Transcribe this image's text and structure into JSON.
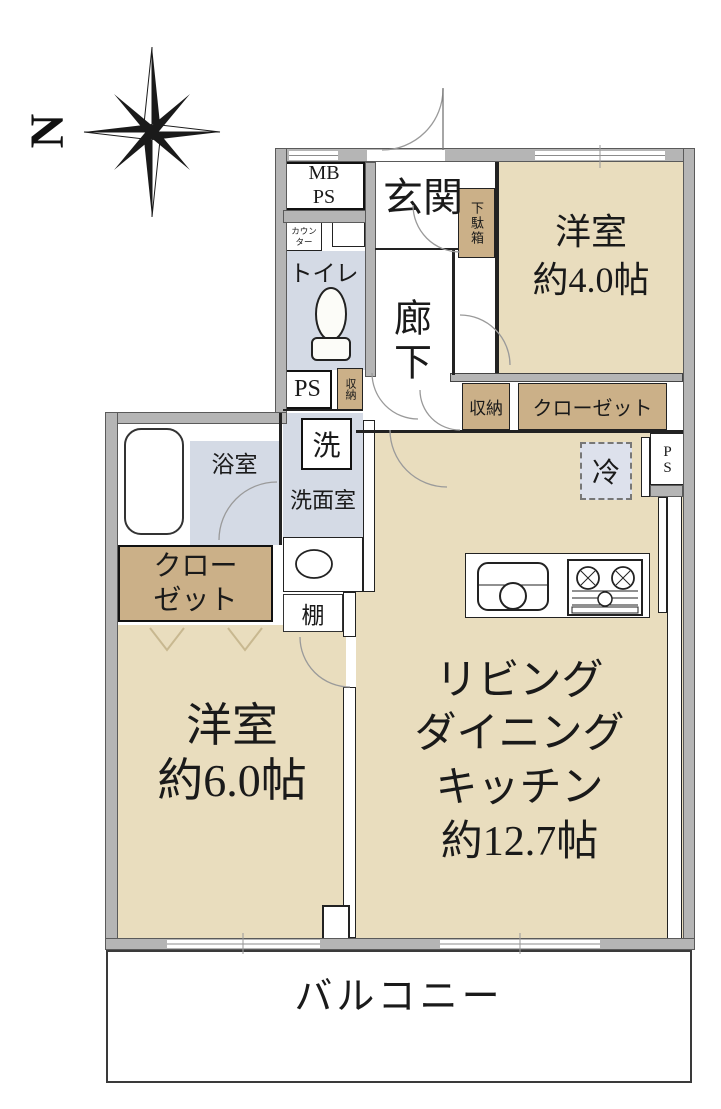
{
  "compass": {
    "north": "N"
  },
  "rooms": {
    "entrance": "玄関",
    "hallway": "廊下",
    "western_4": "洋室\n約4.0帖",
    "western_6": "洋室\n約6.0帖",
    "ldk": "リビング\nダイニング\nキッチン\n約12.7帖",
    "toilet": "トイレ",
    "bathroom": "浴室",
    "washroom": "洗面室",
    "balcony": "バルコニー"
  },
  "fixtures": {
    "mb_ps": "MB\nPS",
    "counter": "カウン\nター",
    "ps_upper": "PS",
    "ps_right": "PS",
    "storage_hall": "収納",
    "storage_mid": "収納",
    "closet_right": "クローゼット",
    "closet_left": "クロー\nゼット",
    "shoe_cabinet": "下駄箱",
    "washer": "洗",
    "refrigerator": "冷",
    "shelf": "棚"
  },
  "colors": {
    "room_beige": "#e9ddbe",
    "closet_tan": "#cbb088",
    "wet_area_blue": "#d4dae5",
    "fridge_blue": "#dde1ec",
    "wall_gray": "#b5b5b5"
  }
}
